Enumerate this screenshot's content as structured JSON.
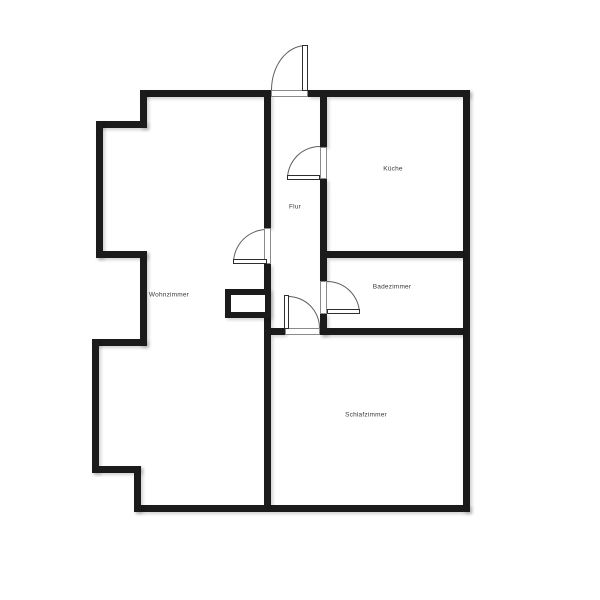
{
  "floorplan": {
    "rooms": {
      "wohnzimmer": {
        "label": "Wohnzimmer"
      },
      "flur": {
        "label": "Flur"
      },
      "kueche": {
        "label": "Küche"
      },
      "badezimmer": {
        "label": "Badezimmer"
      },
      "schlafzimmer": {
        "label": "Schlafzimmer"
      }
    },
    "doors": [
      {
        "name": "entrance-door",
        "swing": "outward-top"
      },
      {
        "name": "kueche-door",
        "swing": "into-flur"
      },
      {
        "name": "wohnzimmer-door",
        "swing": "into-wohnzimmer"
      },
      {
        "name": "schlafzimmer-door",
        "swing": "into-flur"
      },
      {
        "name": "badezimmer-door",
        "swing": "into-badezimmer"
      }
    ],
    "colors": {
      "wall": "#1b1b1b",
      "background": "#ffffff",
      "label_text": "#3a3a3a",
      "door_line": "#5f5f5f"
    }
  }
}
